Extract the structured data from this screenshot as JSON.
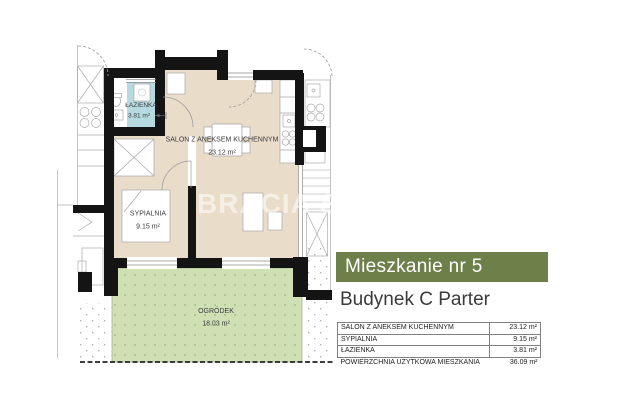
{
  "watermark": "BRACIA S",
  "panel": {
    "title": "Mieszkanie nr 5",
    "subtitle": "Budynek C Parter",
    "accent_color": "#6d8049",
    "table": {
      "rows": [
        {
          "label": "SALON Z ANEKSEM KUCHENNYM",
          "value": "23.12 m²"
        },
        {
          "label": "SYPIALNIA",
          "value": "9.15 m²"
        },
        {
          "label": "ŁAZIENKA",
          "value": "3.81 m²"
        },
        {
          "label": "POWIERZCHNIA UŻYTKOWA MIESZKANIA",
          "value": "36.09 m²"
        }
      ]
    }
  },
  "plan": {
    "rooms": [
      {
        "name": "ŁAZIENKA",
        "area": "3.81 m²",
        "color": "#b5dbe0"
      },
      {
        "name": "SALON Z ANEKSEM KUCHENNYM",
        "area": "23.12 m²",
        "color": "#e9ddc9"
      },
      {
        "name": "SYPIALNIA",
        "area": "9.15 m²",
        "color": "#e9ddc9"
      },
      {
        "name": "OGRÓDEK",
        "area": "18.03 m²",
        "color": "#cfe0b5"
      }
    ],
    "colors": {
      "wall": "#141414",
      "fixture_line": "#a6a6a6",
      "garden_dot": "#a9c58b",
      "label_text": "#3b3b3b"
    }
  }
}
